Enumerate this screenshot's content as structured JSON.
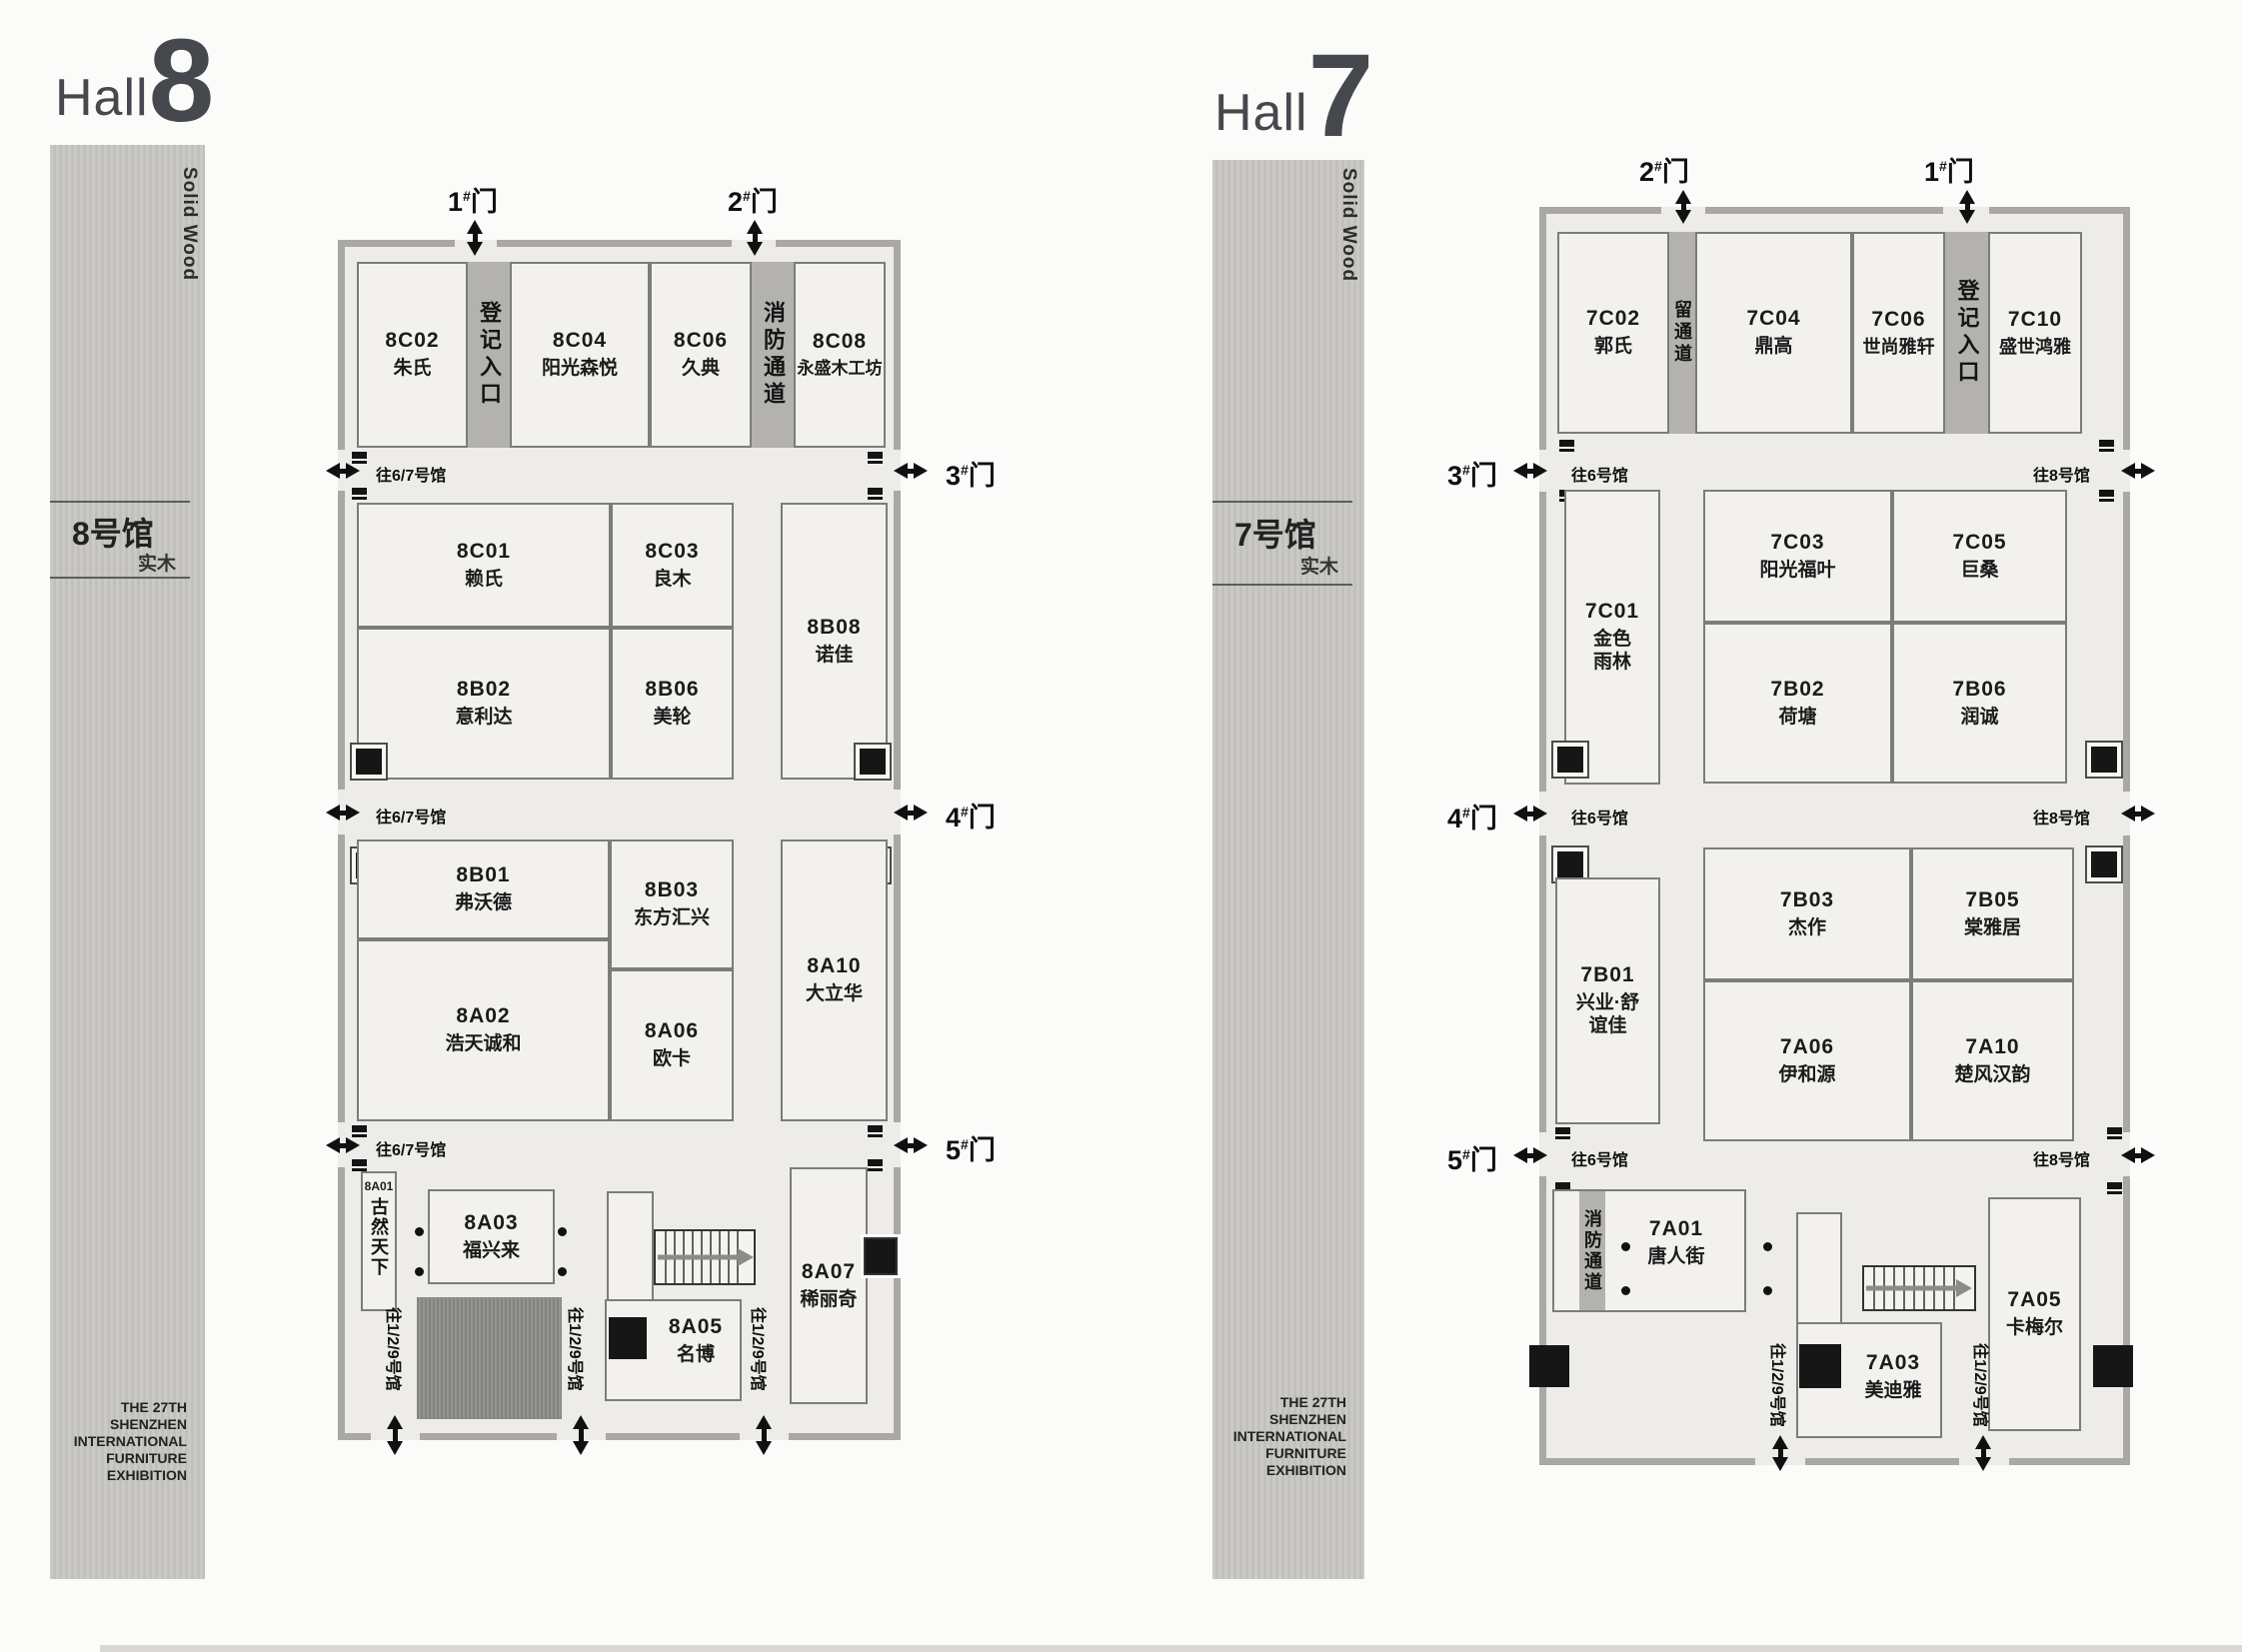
{
  "exhibition": {
    "footer_lines": [
      "THE 27TH",
      "SHENZHEN",
      "INTERNATIONAL",
      "FURNITURE",
      "EXHIBITION"
    ]
  },
  "hall8": {
    "title_word": "Hall",
    "title_num": "8",
    "sidebar": {
      "solid_wood": "Solid Wood",
      "hall_cn": "8号馆",
      "material_cn": "实木"
    },
    "doors": {
      "d1": {
        "num": "1",
        "hash": "#",
        "suffix": "门"
      },
      "d2": {
        "num": "2",
        "hash": "#",
        "suffix": "门"
      },
      "d3": {
        "num": "3",
        "hash": "#",
        "suffix": "门"
      },
      "d4": {
        "num": "4",
        "hash": "#",
        "suffix": "门"
      },
      "d5": {
        "num": "5",
        "hash": "#",
        "suffix": "门"
      }
    },
    "passages": {
      "to67": "往6/7号馆",
      "to129": "往1/2/9号馆"
    },
    "strips": {
      "registration": "登记入口",
      "fire": "消防通道"
    },
    "booths": {
      "b8C02": {
        "code": "8C02",
        "name": "朱氏"
      },
      "b8C04": {
        "code": "8C04",
        "name": "阳光森悦"
      },
      "b8C06": {
        "code": "8C06",
        "name": "久典"
      },
      "b8C08": {
        "code": "8C08",
        "name": "永盛木工坊"
      },
      "b8C01": {
        "code": "8C01",
        "name": "赖氏"
      },
      "b8C03": {
        "code": "8C03",
        "name": "良木"
      },
      "b8B02": {
        "code": "8B02",
        "name": "意利达"
      },
      "b8B06": {
        "code": "8B06",
        "name": "美轮"
      },
      "b8B08": {
        "code": "8B08",
        "name": "诺佳"
      },
      "b8B01": {
        "code": "8B01",
        "name": "弗沃德"
      },
      "b8B03": {
        "code": "8B03",
        "name": "东方汇兴"
      },
      "b8A02": {
        "code": "8A02",
        "name": "浩天诚和"
      },
      "b8A06": {
        "code": "8A06",
        "name": "欧卡"
      },
      "b8A10": {
        "code": "8A10",
        "name": "大立华"
      },
      "b8A01": {
        "code": "8A01",
        "name": "古然天下"
      },
      "b8A03": {
        "code": "8A03",
        "name": "福兴来"
      },
      "b8A05": {
        "code": "8A05",
        "name": "名博"
      },
      "b8A07": {
        "code": "8A07",
        "name": "稀丽奇"
      }
    }
  },
  "hall7": {
    "title_word": "Hall",
    "title_num": "7",
    "sidebar": {
      "solid_wood": "Solid Wood",
      "hall_cn": "7号馆",
      "material_cn": "实木"
    },
    "doors": {
      "d1": {
        "num": "1",
        "hash": "#",
        "suffix": "门"
      },
      "d2": {
        "num": "2",
        "hash": "#",
        "suffix": "门"
      },
      "d3": {
        "num": "3",
        "hash": "#",
        "suffix": "门"
      },
      "d4": {
        "num": "4",
        "hash": "#",
        "suffix": "门"
      },
      "d5": {
        "num": "5",
        "hash": "#",
        "suffix": "门"
      }
    },
    "passages": {
      "to6": "往6号馆",
      "to8": "往8号馆",
      "to129": "往1/2/9号馆"
    },
    "strips": {
      "reserved": "留通道",
      "registration": "登记入口",
      "fire": "消防通道"
    },
    "booths": {
      "b7C02": {
        "code": "7C02",
        "name": "郭氏"
      },
      "b7C04": {
        "code": "7C04",
        "name": "鼎高"
      },
      "b7C06": {
        "code": "7C06",
        "name": "世尚雅轩"
      },
      "b7C10": {
        "code": "7C10",
        "name": "盛世鸿雅"
      },
      "b7C01": {
        "code": "7C01",
        "name": "金色雨林"
      },
      "b7C03": {
        "code": "7C03",
        "name": "阳光福叶"
      },
      "b7C05": {
        "code": "7C05",
        "name": "巨桑"
      },
      "b7B02": {
        "code": "7B02",
        "name": "荷塘"
      },
      "b7B06": {
        "code": "7B06",
        "name": "润诚"
      },
      "b7B01": {
        "code": "7B01",
        "name": "兴业·舒谊佳"
      },
      "b7B03": {
        "code": "7B03",
        "name": "杰作"
      },
      "b7B05": {
        "code": "7B05",
        "name": "棠雅居"
      },
      "b7A06": {
        "code": "7A06",
        "name": "伊和源"
      },
      "b7A10": {
        "code": "7A10",
        "name": "楚风汉韵"
      },
      "b7A01": {
        "code": "7A01",
        "name": "唐人街"
      },
      "b7A03": {
        "code": "7A03",
        "name": "美迪雅"
      },
      "b7A05": {
        "code": "7A05",
        "name": "卡梅尔"
      }
    }
  }
}
